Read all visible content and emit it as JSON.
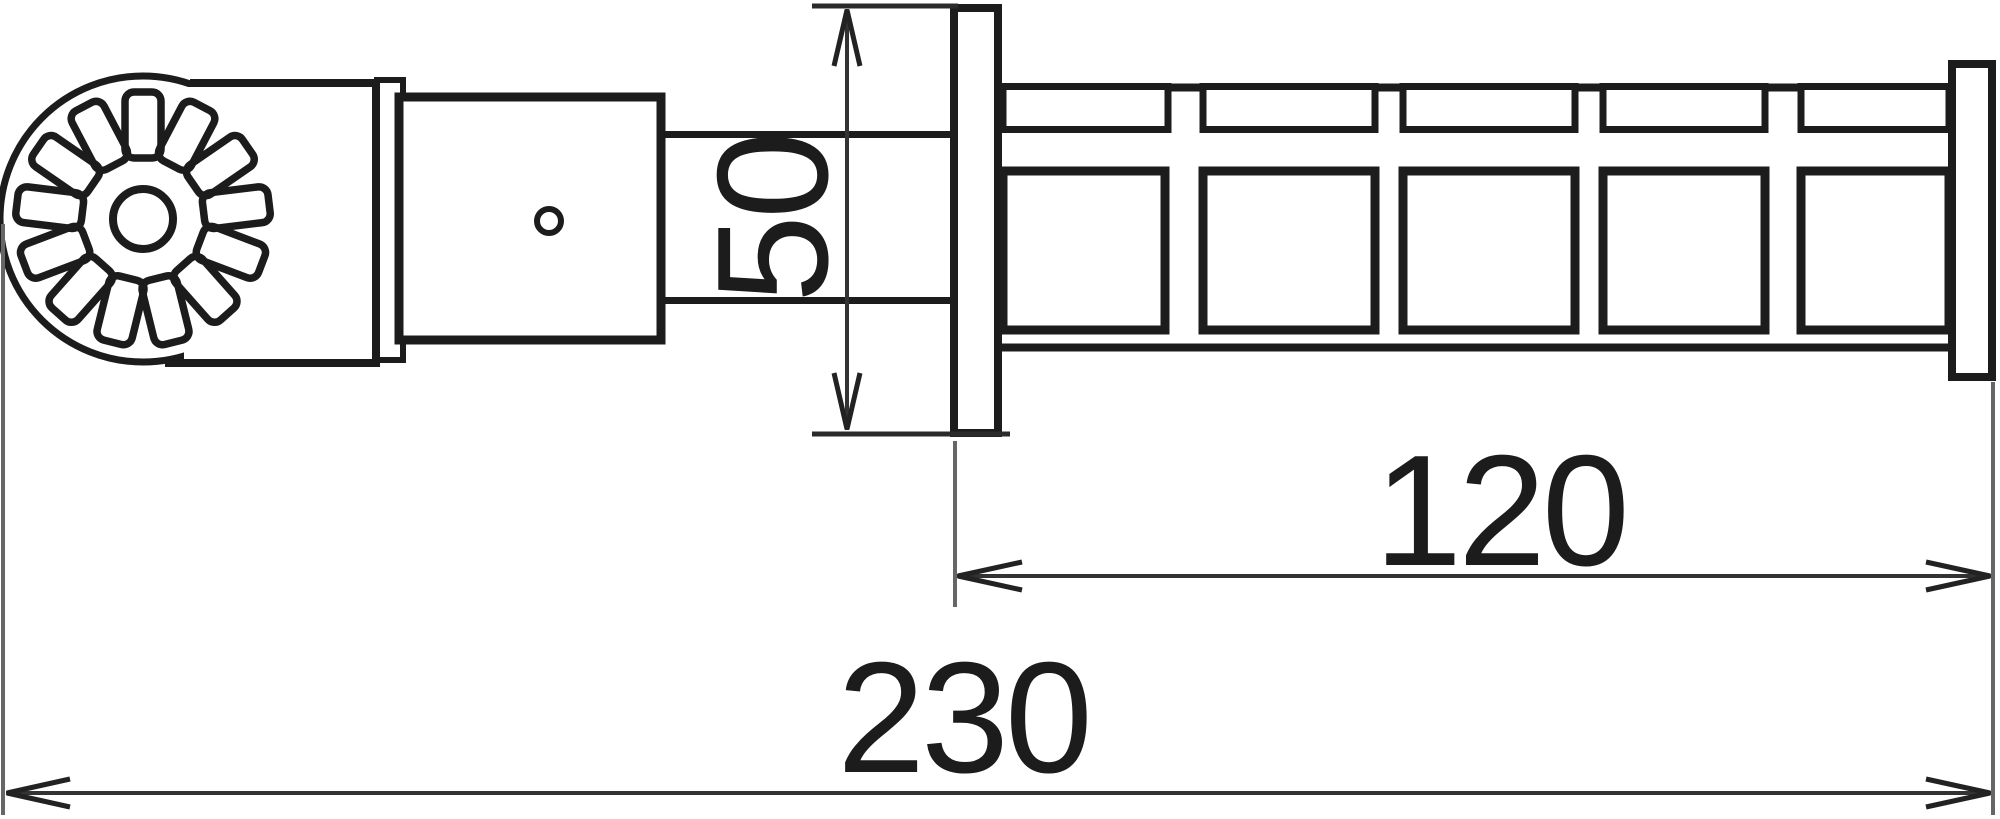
{
  "drawing": {
    "dimensions": {
      "flange_height": {
        "label": "50"
      },
      "handle_length": {
        "label": "120"
      },
      "overall_length": {
        "label": "230"
      }
    },
    "colors": {
      "ink": "#1c1c1c",
      "dimension_line": "#333333",
      "extension_line": "#666666",
      "background": "#ffffff"
    }
  }
}
